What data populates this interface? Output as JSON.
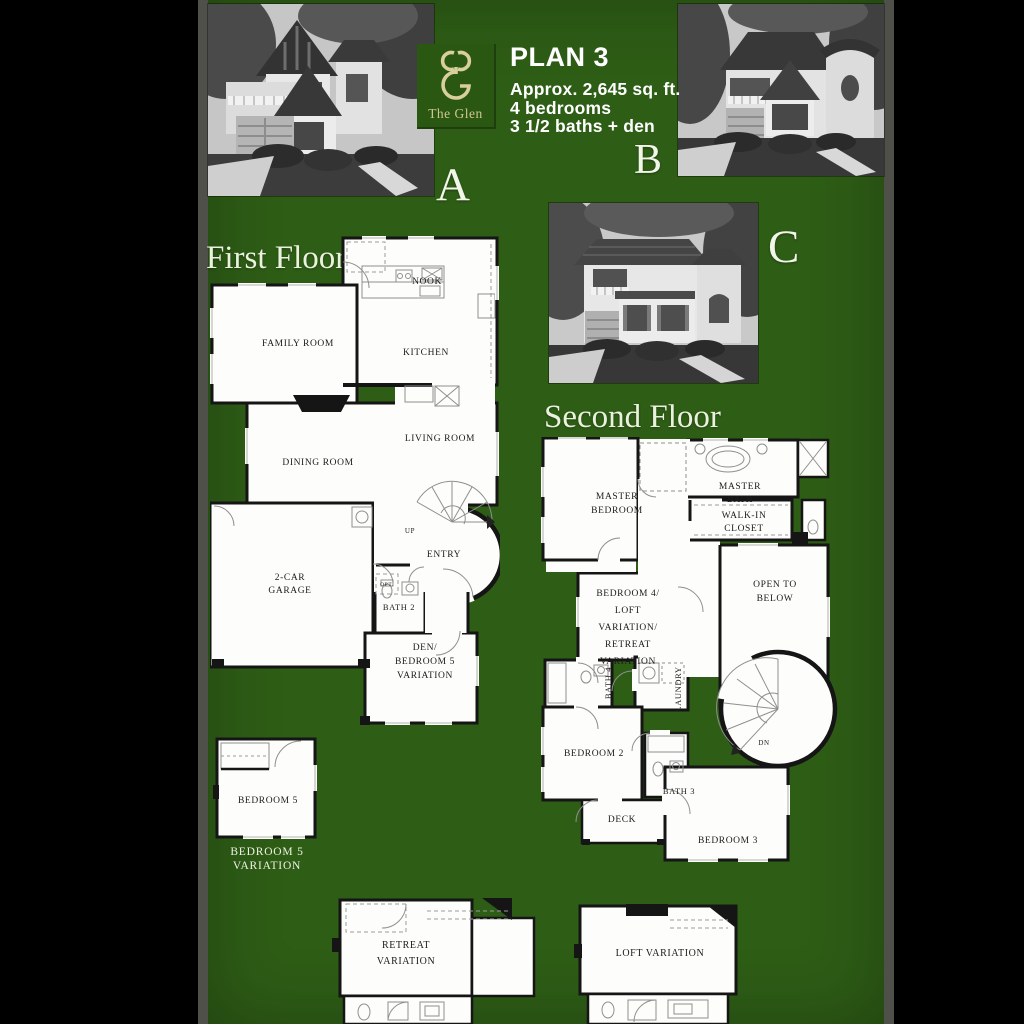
{
  "colors": {
    "background": "#000000",
    "canvas_green": "#2e5d16",
    "edge_strip": "#50504a",
    "logo_gold": "#d8cf9d",
    "heading_text": "#eaf1dc",
    "body_text": "#ffffff",
    "plan_wall": "#151515",
    "plan_paper": "#fdfdfb"
  },
  "branding": {
    "logo_name": "The Glen",
    "monogram_icon": "glen-monogram"
  },
  "header": {
    "plan_title": "PLAN 3",
    "detail_line1": "Approx. 2,645 sq. ft.",
    "detail_line2": "4 bedrooms",
    "detail_line3": "3 1/2 baths + den"
  },
  "elevations": {
    "a": {
      "letter": "A",
      "style": "Tudor two-story home photo (grayscale)"
    },
    "b": {
      "letter": "B",
      "style": "French cottage with turret photo (grayscale)"
    },
    "c": {
      "letter": "C",
      "style": "Spanish colonial home photo (grayscale)"
    }
  },
  "first_floor": {
    "heading": "First Floor",
    "labels": {
      "nook": "NOOK",
      "family_room": "FAMILY ROOM",
      "kitchen": "KITCHEN",
      "dining_room": "DINING ROOM",
      "living_room": "LIVING ROOM",
      "up": "UP",
      "entry": "ENTRY",
      "opt": "OPT.",
      "bath2": "BATH 2",
      "garage_line1": "2-CAR",
      "garage_line2": "GARAGE",
      "den_line1": "DEN/",
      "den_line2": "BEDROOM 5",
      "den_line3": "VARIATION"
    }
  },
  "second_floor": {
    "heading": "Second Floor",
    "labels": {
      "master_line1": "MASTER",
      "master_line2": "BEDROOM",
      "mbath_line1": "MASTER",
      "mbath_line2": "BATH",
      "wic_line1": "WALK-IN",
      "wic_line2": "CLOSET",
      "bed4_line1": "BEDROOM 4/",
      "bed4_line2": "LOFT",
      "bed4_line3": "VARIATION/",
      "bed4_line4": "RETREAT",
      "bed4_line5": "VARIATION",
      "open_line1": "OPEN TO",
      "open_line2": "BELOW",
      "bath4": "BATH 4",
      "laundry": "LAUNDRY",
      "bedroom2": "BEDROOM 2",
      "bath3": "BATH 3",
      "deck": "DECK",
      "bedroom3": "BEDROOM 3",
      "dn": "DN"
    }
  },
  "variations": {
    "bedroom5_plan_label": "BEDROOM 5",
    "bedroom5_caption_line1": "BEDROOM 5",
    "bedroom5_caption_line2": "VARIATION",
    "retreat_line1": "RETREAT",
    "retreat_line2": "VARIATION",
    "loft": "LOFT VARIATION"
  }
}
